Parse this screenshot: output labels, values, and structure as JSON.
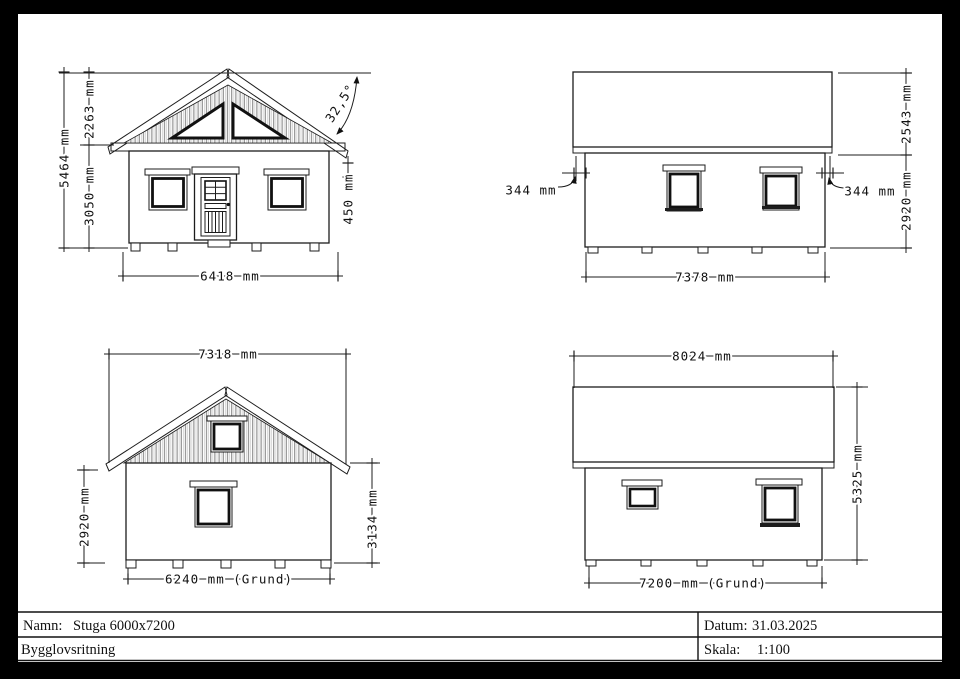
{
  "sheet": {
    "background_color": "#000000",
    "paper_color": "#ffffff",
    "line_color": "#1c1c1c",
    "roof_gray": "#909090"
  },
  "elevations": {
    "front": {
      "dims": {
        "total_height": "5464 mm",
        "gable_height": "2263 mm",
        "wall_height": "3050 mm",
        "width": "6418 mm",
        "eave_drop": "450 mm",
        "roof_angle": "32,5°"
      }
    },
    "side_right": {
      "dims": {
        "roof_height": "2543 mm",
        "wall_height": "2920 mm",
        "overhang_left": "344 mm",
        "overhang_right": "344 mm",
        "width": "7378 mm"
      }
    },
    "rear": {
      "dims": {
        "width": "7318 mm",
        "wall_height": "2920 mm",
        "total_height": "3134 mm",
        "foundation_width": "6240 mm (Grund)"
      }
    },
    "side_left": {
      "dims": {
        "width": "8024 mm",
        "total_height": "5325 mm",
        "foundation_width": "7200 mm (Grund)"
      }
    }
  },
  "title_block": {
    "name_label": "Namn:",
    "name_value": "Stuga 6000x7200",
    "document_type": "Bygglovsritning",
    "date_label": "Datum:",
    "date_value": "31.03.2025",
    "scale_label": "Skala:",
    "scale_value": "1:100"
  }
}
